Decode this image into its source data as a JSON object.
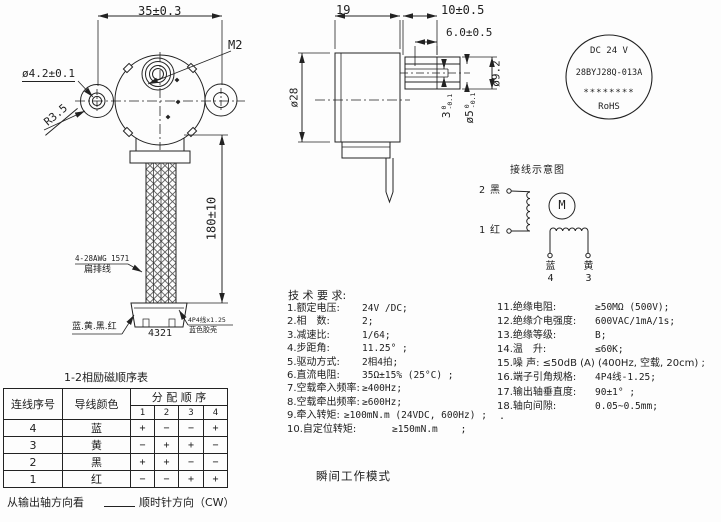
{
  "front_view": {
    "dim_width": "35±0.3",
    "thread_label": "M2",
    "hole_dim": "ø4.2±0.1",
    "fillet_dim": "R3.5",
    "lead_length_dim": "180±10",
    "wire_gauge": "4-28AWG 1571",
    "wire_type": "扁排线",
    "lead_colors": "蓝.黄.黑.红",
    "pin_order": "4321",
    "connector_type": "4P4线x1.25",
    "connector_color": "蓝色胶壳"
  },
  "side_view": {
    "body_length": "19",
    "shaft_length": "10±0.5",
    "flat_length": "6.0±0.5",
    "body_dia": "ø28",
    "boss_dia": "ø9.2",
    "flat_thickness": "3",
    "flat_tol_upper": "0",
    "flat_tol_lower": "-0.1",
    "shaft_dia": "ø5",
    "shaft_tol_upper": "0",
    "shaft_tol_lower": "-0.1"
  },
  "nameplate": {
    "voltage": "DC 24 V",
    "model": "28BYJ28Q-013A",
    "stars": "********",
    "rohs": "RoHS"
  },
  "wiring_diagram": {
    "title": "接线示意图",
    "terminal_2_num": "2",
    "terminal_2_color": "黑",
    "terminal_1_num": "1",
    "terminal_1_color": "红",
    "motor_symbol": "M",
    "lead_blue": "蓝",
    "lead_blue_num": "4",
    "lead_yellow": "黄",
    "lead_yellow_num": "3"
  },
  "phase_table": {
    "title": "1-2相励磁顺序表",
    "header_wire_no": "连线序号",
    "header_wire_color": "导线颜色",
    "header_sequence": "分 配 顺 序",
    "steps": [
      "1",
      "2",
      "3",
      "4"
    ],
    "rows": [
      {
        "no": "4",
        "color": "蓝",
        "seq": [
          "+",
          "−",
          "−",
          "+"
        ]
      },
      {
        "no": "3",
        "color": "黄",
        "seq": [
          "−",
          "+",
          "+",
          "−"
        ]
      },
      {
        "no": "2",
        "color": "黑",
        "seq": [
          "+",
          "+",
          "−",
          "−"
        ]
      },
      {
        "no": "1",
        "color": "红",
        "seq": [
          "−",
          "−",
          "+",
          "+"
        ]
      }
    ]
  },
  "tech_specs": {
    "title": "技 术 要 求:",
    "left": [
      {
        "label": "1.额定电压:",
        "value": "24V /DC;"
      },
      {
        "label": "2.相　数:",
        "value": "2;"
      },
      {
        "label": "3.减速比:",
        "value": "1/64;"
      },
      {
        "label": "4.步距角:",
        "value": "11.25° ;"
      },
      {
        "label": "5.驱动方式:",
        "value": "2相4拍;"
      },
      {
        "label": "6.直流电阻:",
        "value": "35Ω±15% (25°C) ;"
      },
      {
        "label": "7.空载牵入频率:",
        "value": "≥400Hz;"
      },
      {
        "label": "8.空载牵出频率:",
        "value": "≥600Hz;"
      },
      {
        "label": "9.牵入转矩:",
        "value": "≥100mN.m (24VDC, 600Hz) ;"
      },
      {
        "label": "10.自定位转矩:",
        "value": "≥150mN.m    ;"
      }
    ],
    "right": [
      {
        "label": "11.绝缘电阻:",
        "value": "≥50MΩ (500V);"
      },
      {
        "label": "12.绝缘介电强度:",
        "value": "600VAC/1mA/1s;"
      },
      {
        "label": "13.绝缘等级:",
        "value": "B;"
      },
      {
        "label": "14.温　升:",
        "value": "≤60K;"
      },
      {
        "label": "15.噪 声: ≤50dB (A) (400Hz, 空载, 20cm) ;",
        "value": ""
      },
      {
        "label": "16.端子引角规格:",
        "value": "4P4线-1.25;"
      },
      {
        "label": "17.输出轴垂直度:",
        "value": "90±1° ;"
      },
      {
        "label": "18.轴向间隙:",
        "value": "0.05~0.5mm;"
      }
    ],
    "footnote": "."
  },
  "notes": {
    "mode": "瞬间工作模式",
    "direction_prefix": "从输出轴方向看",
    "direction_suffix": "顺时针方向（CW）"
  }
}
